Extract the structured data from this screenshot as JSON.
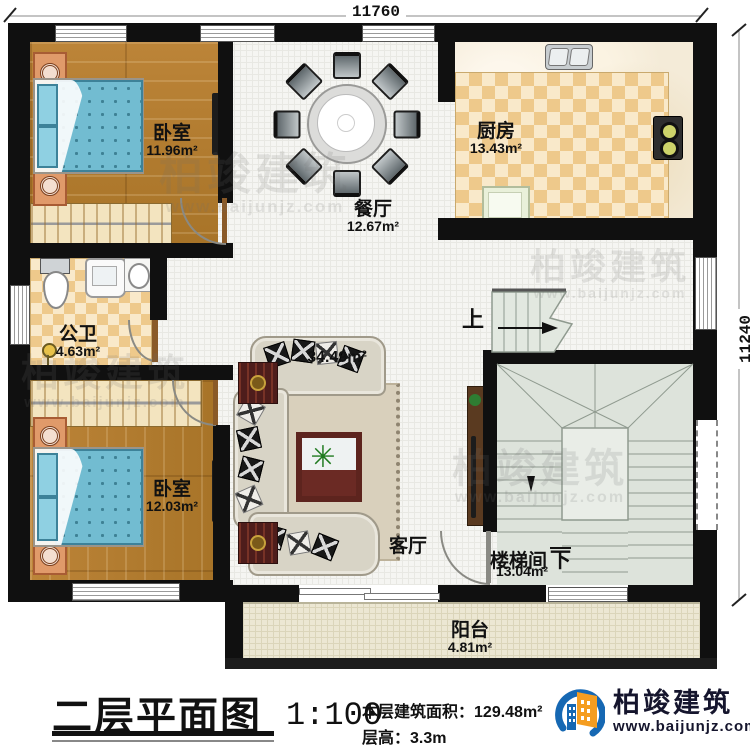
{
  "dimensions": {
    "top": "11760",
    "right": "11240"
  },
  "rooms": {
    "bedroom1": {
      "name": "卧室",
      "area": "11.96m²"
    },
    "dining": {
      "name": "餐厅",
      "area": "12.67m²"
    },
    "kitchen": {
      "name": "厨房",
      "area": "13.43m²"
    },
    "bathroom": {
      "name": "公卫",
      "area": "4.63m²"
    },
    "living": {
      "name": "客厅",
      "area": "34.49m²"
    },
    "bedroom2": {
      "name": "卧室",
      "area": "12.03m²"
    },
    "stairwell": {
      "name": "楼梯间",
      "area": "13.04m²",
      "direction_down": "下"
    },
    "balcony": {
      "name": "阳台",
      "area": "4.81m²"
    }
  },
  "stairs": {
    "up_label": "上"
  },
  "titleblock": {
    "title": "二层平面图",
    "scale": "1:100",
    "floor_area_label": "本层建筑面积：",
    "floor_area_value": "129.48m²",
    "floor_height_label": "层高：",
    "floor_height_value": "3.3m"
  },
  "brand": {
    "name": "柏竣建筑",
    "website": "www.baijunjz.com"
  },
  "watermark": {
    "name": "柏竣建筑",
    "website": "www.baijunjz.com"
  },
  "colors": {
    "wall": "#101010",
    "wood": "#b27c32",
    "tile": "#f5f5f2",
    "checker": "#eec98b",
    "stairs": "#dde3db",
    "balcony": "#ece7d3",
    "logo_blue": "#1668b3",
    "logo_orange": "#f59d20"
  }
}
